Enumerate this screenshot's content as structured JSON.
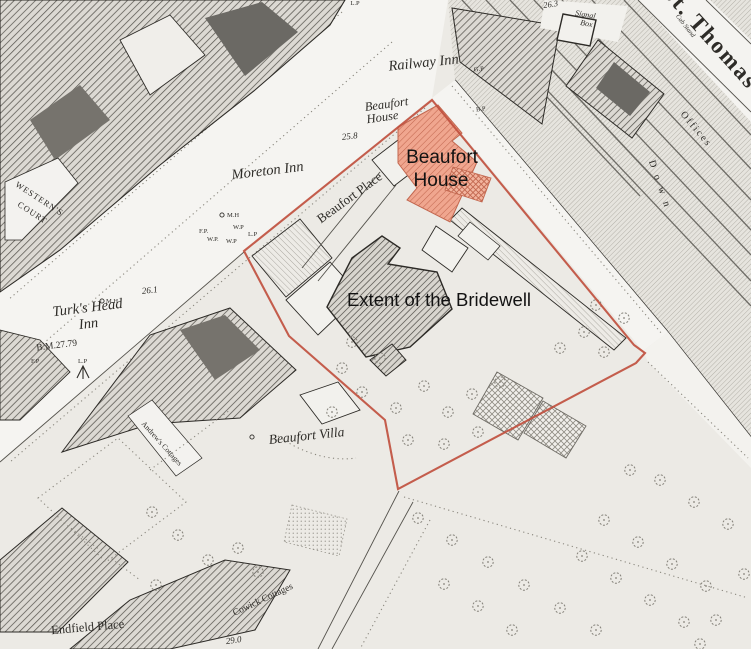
{
  "map": {
    "colors": {
      "paper": "#eceae5",
      "extent_outline": "#c0503f",
      "highlight_fill": "#f0a68f"
    },
    "annotations": {
      "beaufort_house_line1": "Beaufort",
      "beaufort_house_line2": "House",
      "extent": "Extent of the Bridewell"
    },
    "labels": {
      "st_thomas": "St. Thomas",
      "cab_stand": "Cab Stand",
      "spot_263": "26.3",
      "signal_line1": "Signal",
      "signal_line2": "Box",
      "lp_top": "L.P",
      "railway_inn": "Railway Inn",
      "gp": "G.P",
      "bp": "B.P",
      "beaufort_house_old_1": "Beaufort",
      "beaufort_house_old_2": "House",
      "spot_258": "25.8",
      "moreton_inn": "Moreton Inn",
      "mh_1": "M.H",
      "wp_1": "W.P",
      "fp_1": "F.P.",
      "wp_2": "W.P.",
      "wp_3": "W.P",
      "lp_1": "L.P",
      "westerns_court_1": "WESTERN'S",
      "westerns_court_2": "COURT",
      "turks_head_1": "Turk's Head",
      "turks_head_2": "Inn",
      "mh_2": "M.H",
      "spot_261": "26.1",
      "bm": "B.M.27.79",
      "fp_2": "F.P",
      "lp_2": "L.P",
      "beaufort_place": "Beaufort Place",
      "beaufort_villa": "Beaufort Villa",
      "andrews_cottages": "Andrew's Cottages",
      "cowick_cottages": "Cowick Cottages",
      "spot_290": "29.0",
      "endfield_place": "Endfield Place",
      "offices": "Offices",
      "down": "Down"
    }
  }
}
